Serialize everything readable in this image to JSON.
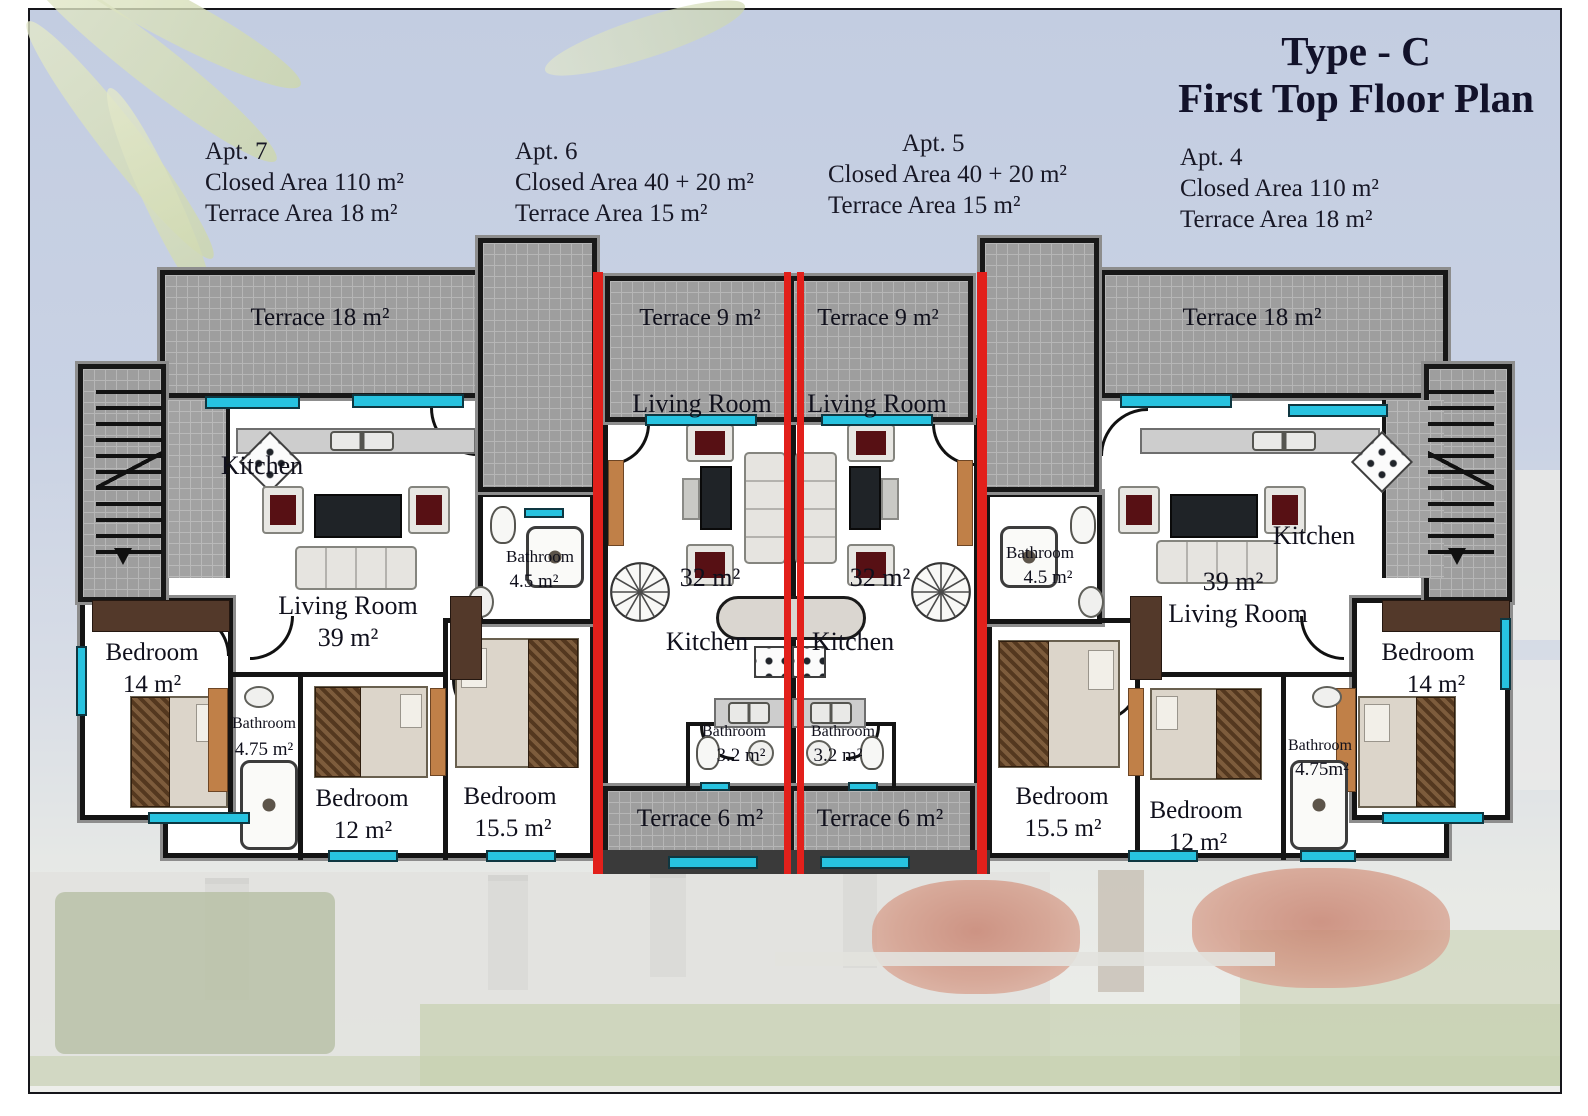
{
  "title": {
    "line1": "Type - C",
    "line2": "First Top Floor Plan"
  },
  "legend": {
    "apt7": {
      "name": "Apt. 7",
      "closed": "Closed Area 110 m²",
      "terrace": "Terrace Area 18 m²"
    },
    "apt6": {
      "name": "Apt. 6",
      "closed": "Closed Area 40 + 20 m²",
      "terrace": "Terrace Area 15 m²"
    },
    "apt5": {
      "name": "Apt. 5",
      "closed": "Closed Area 40 + 20 m²",
      "terrace": "Terrace Area 15 m²"
    },
    "apt4": {
      "name": "Apt. 4",
      "closed": "Closed Area 110 m²",
      "terrace": "Terrace Area 18 m²"
    }
  },
  "plan": {
    "apt7": {
      "terrace": "Terrace 18 m²",
      "kitchen": "Kitchen",
      "living_name": "Living Room",
      "living_area": "39 m²",
      "bedroom14_name": "Bedroom",
      "bedroom14_area": "14 m²",
      "bathroom475_name": "Bathroom",
      "bathroom475_area": "4.75 m²",
      "bedroom12_name": "Bedroom",
      "bedroom12_area": "12 m²",
      "bedroom155_name": "Bedroom",
      "bedroom155_area": "15.5 m²",
      "bathroom45_name": "Bathroom",
      "bathroom45_area": "4.5 m²"
    },
    "apt6": {
      "terrace_top": "Terrace 9 m²",
      "living_name": "Living Room",
      "living_area": "32 m²",
      "kitchen": "Kitchen",
      "bathroom_name": "Bathroom",
      "bathroom_area": "3.2 m²",
      "terrace_bottom": "Terrace 6 m²"
    },
    "apt5": {
      "terrace_top": "Terrace 9 m²",
      "living_name": "Living Room",
      "living_area": "32 m²",
      "kitchen": "Kitchen",
      "bathroom_name": "Bathroom",
      "bathroom_area": "3.2 m²",
      "terrace_bottom": "Terrace 6 m²"
    },
    "apt4": {
      "terrace": "Terrace 18 m²",
      "kitchen": "Kitchen",
      "living_area": "39 m²",
      "living_name": "Living Room",
      "bedroom155_name": "Bedroom",
      "bedroom155_area": "15.5 m²",
      "bedroom12_name": "Bedroom",
      "bedroom12_area": "12 m²",
      "bedroom14_name": "Bedroom",
      "bedroom14_area": "14 m²",
      "bathroom475_name": "Bathroom",
      "bathroom475_area": "4.75m²",
      "bathroom45_name": "Bathroom",
      "bathroom45_area": "4.5 m²"
    }
  },
  "colors": {
    "divider_red": "#e2201b",
    "window_cyan": "#27c3e0",
    "terrace_gray": "#9e9e9e",
    "wall_black": "#141414",
    "sky_blue": "#c7d1e3"
  }
}
